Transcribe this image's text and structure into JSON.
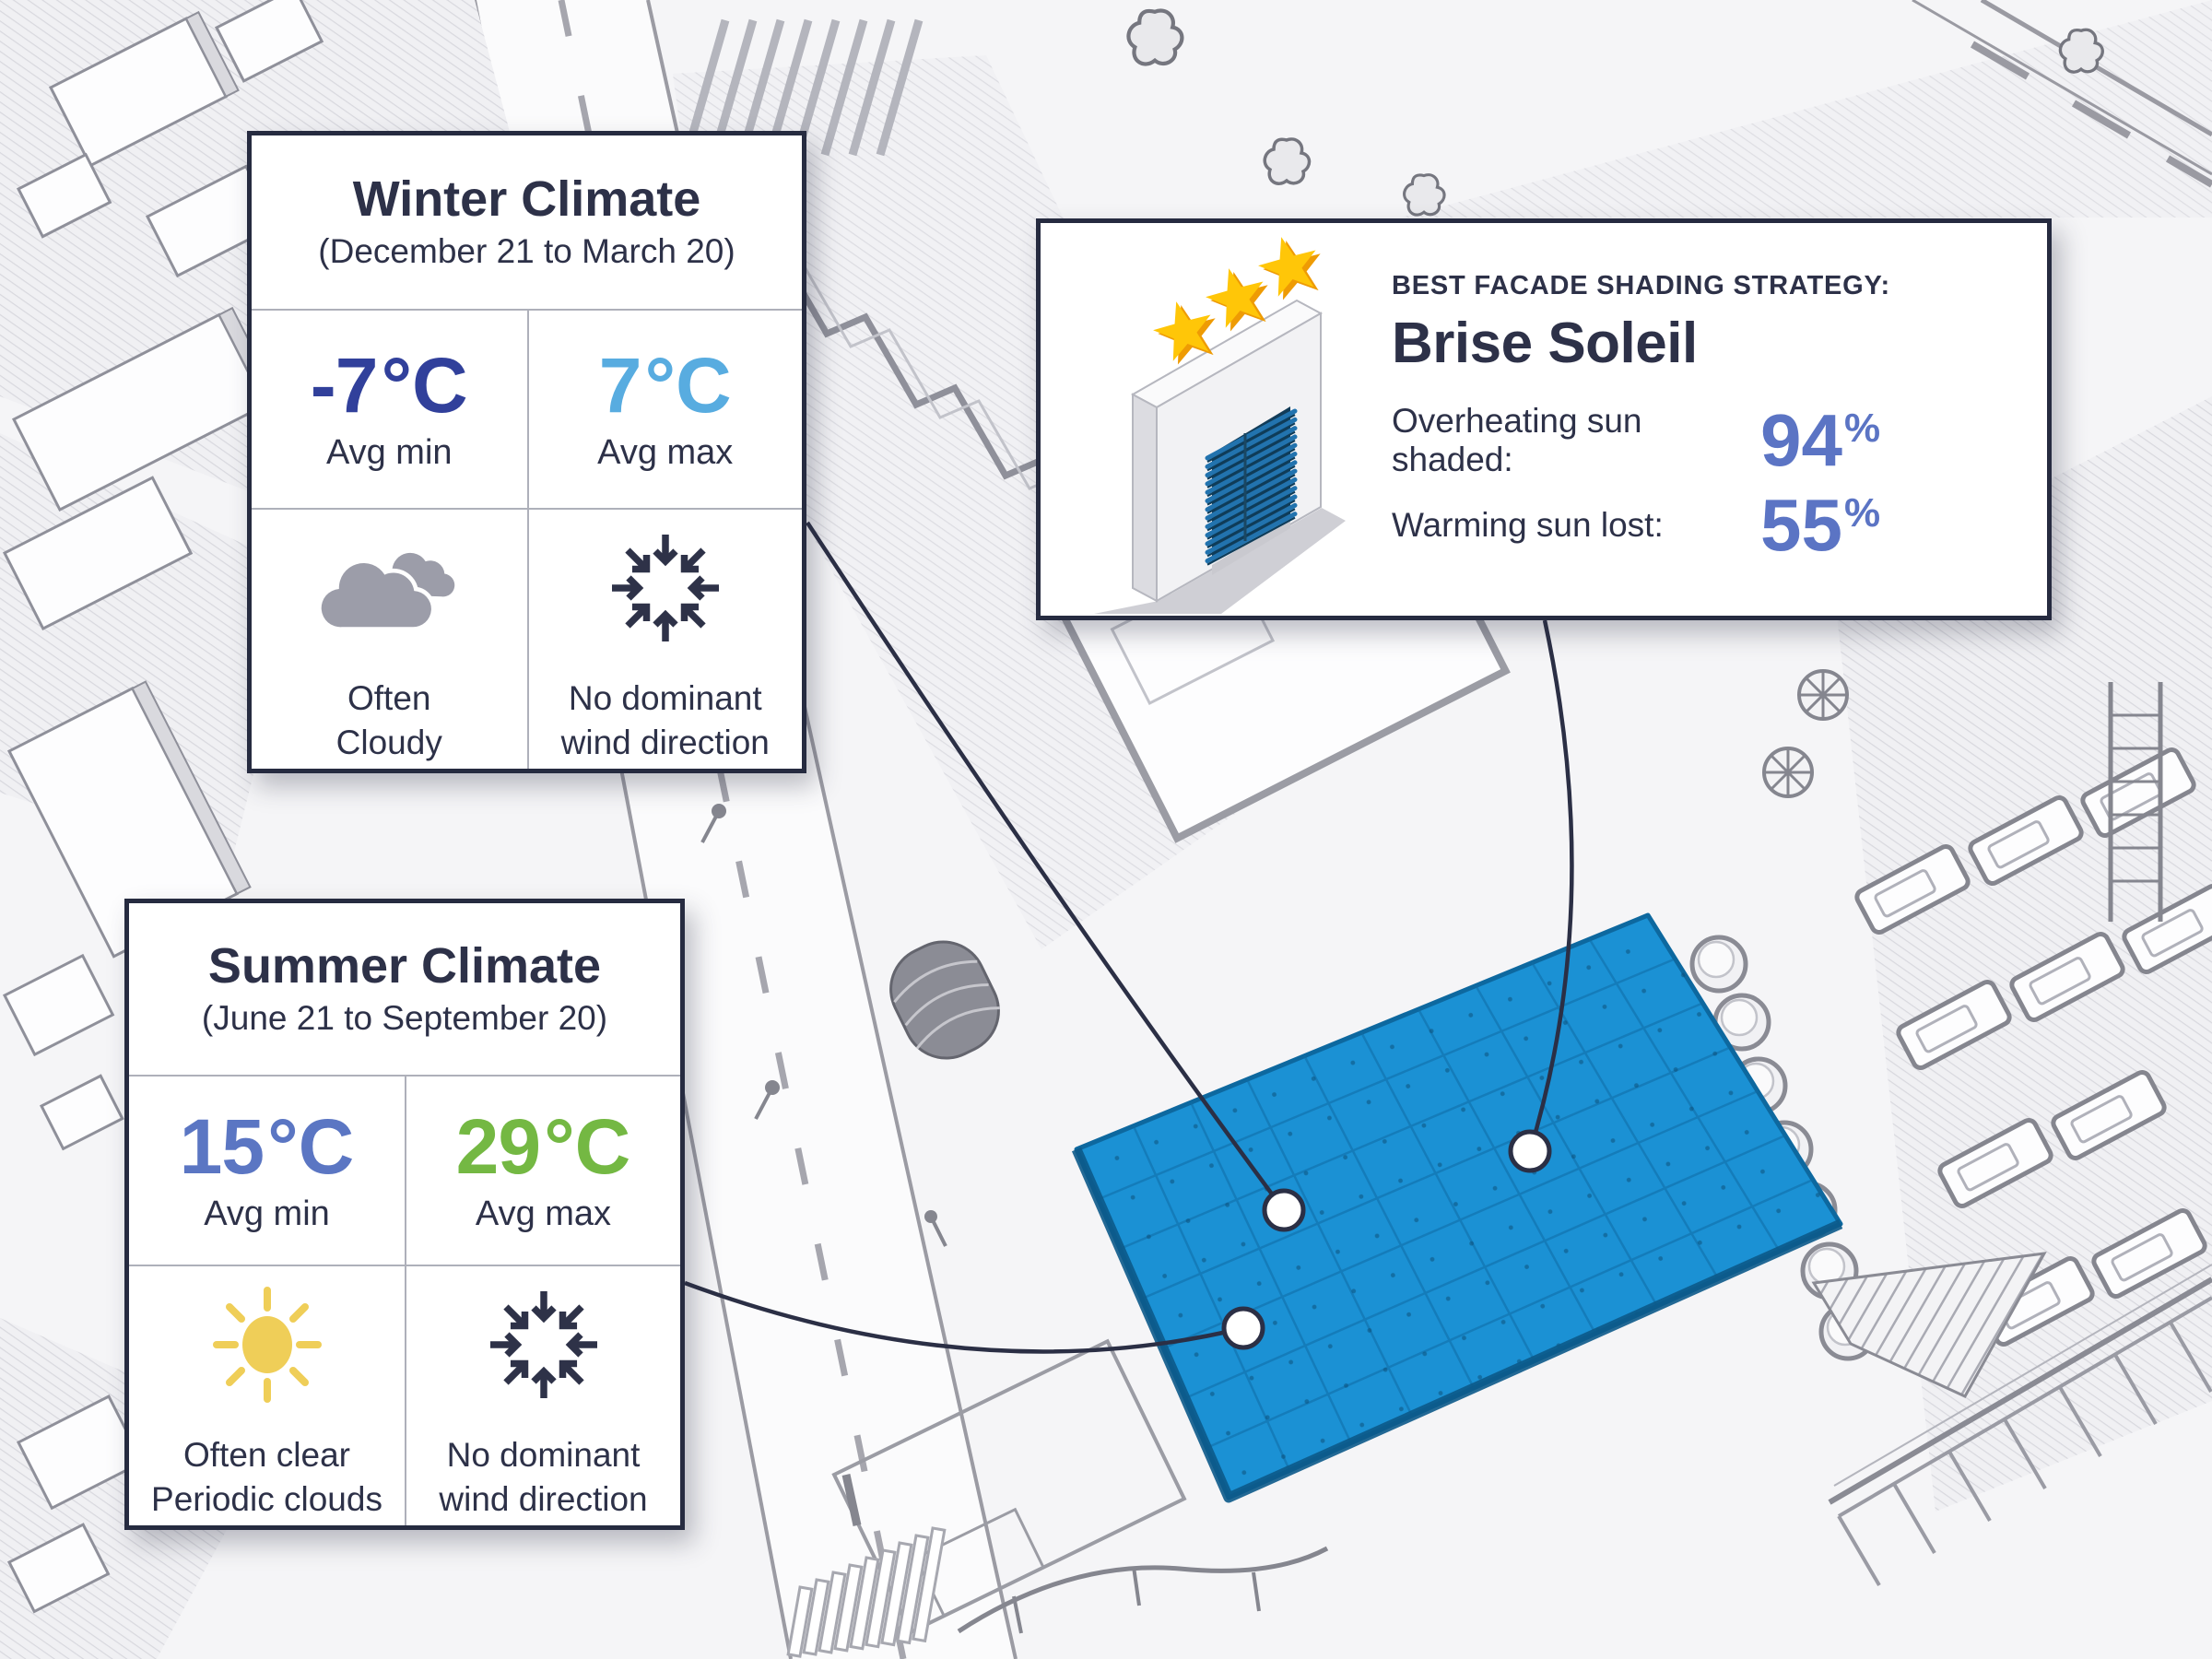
{
  "winter_card": {
    "title": "Winter Climate",
    "subtitle": "(December 21 to March 20)",
    "avg_min": {
      "value": "-7",
      "unit": "°C",
      "label": "Avg min",
      "color": "#31409b"
    },
    "avg_max": {
      "value": "7",
      "unit": "°C",
      "label": "Avg max",
      "color": "#58ace0"
    },
    "sky": {
      "icon": "clouds-icon",
      "line1": "Often",
      "line2": "Cloudy"
    },
    "wind": {
      "icon": "converging-arrows-icon",
      "line1": "No dominant",
      "line2": "wind direction"
    }
  },
  "summer_card": {
    "title": "Summer Climate",
    "subtitle": "(June 21 to September 20)",
    "avg_min": {
      "value": "15",
      "unit": "°C",
      "label": "Avg min",
      "color": "#5b76c3"
    },
    "avg_max": {
      "value": "29",
      "unit": "°C",
      "label": "Avg max",
      "color": "#74b843"
    },
    "sky": {
      "icon": "sun-icon",
      "line1": "Often clear",
      "line2": "Periodic clouds"
    },
    "wind": {
      "icon": "converging-arrows-icon",
      "line1": "No dominant",
      "line2": "wind direction"
    }
  },
  "strategy_card": {
    "eyebrow": "BEST FACADE SHADING STRATEGY:",
    "title": "Brise Soleil",
    "rating": {
      "icon": "three-stars-icon",
      "stars": 3
    },
    "illustration": "brise-soleil-louvered-wall-icon",
    "metrics": [
      {
        "label": "Overheating sun shaded:",
        "value": "94",
        "unit": "%"
      },
      {
        "label": "Warming sun lost:",
        "value": "55",
        "unit": "%"
      }
    ]
  },
  "site_plan": {
    "highlight_panel": {
      "name": "proposed-site-area",
      "color": "#1b91d4"
    },
    "markers": 3,
    "connector_color": "#2b2f45"
  },
  "palette": {
    "text_navy": "#2d3148",
    "card_border": "#262b40",
    "periwinkle": "#5b74c4",
    "sky_blue": "#58ace0",
    "green": "#74b843",
    "sun_yellow": "#efce58",
    "cloud_gray": "#9c9da9",
    "star_gold": "#ffc608",
    "panel_blue": "#1b91d4"
  }
}
